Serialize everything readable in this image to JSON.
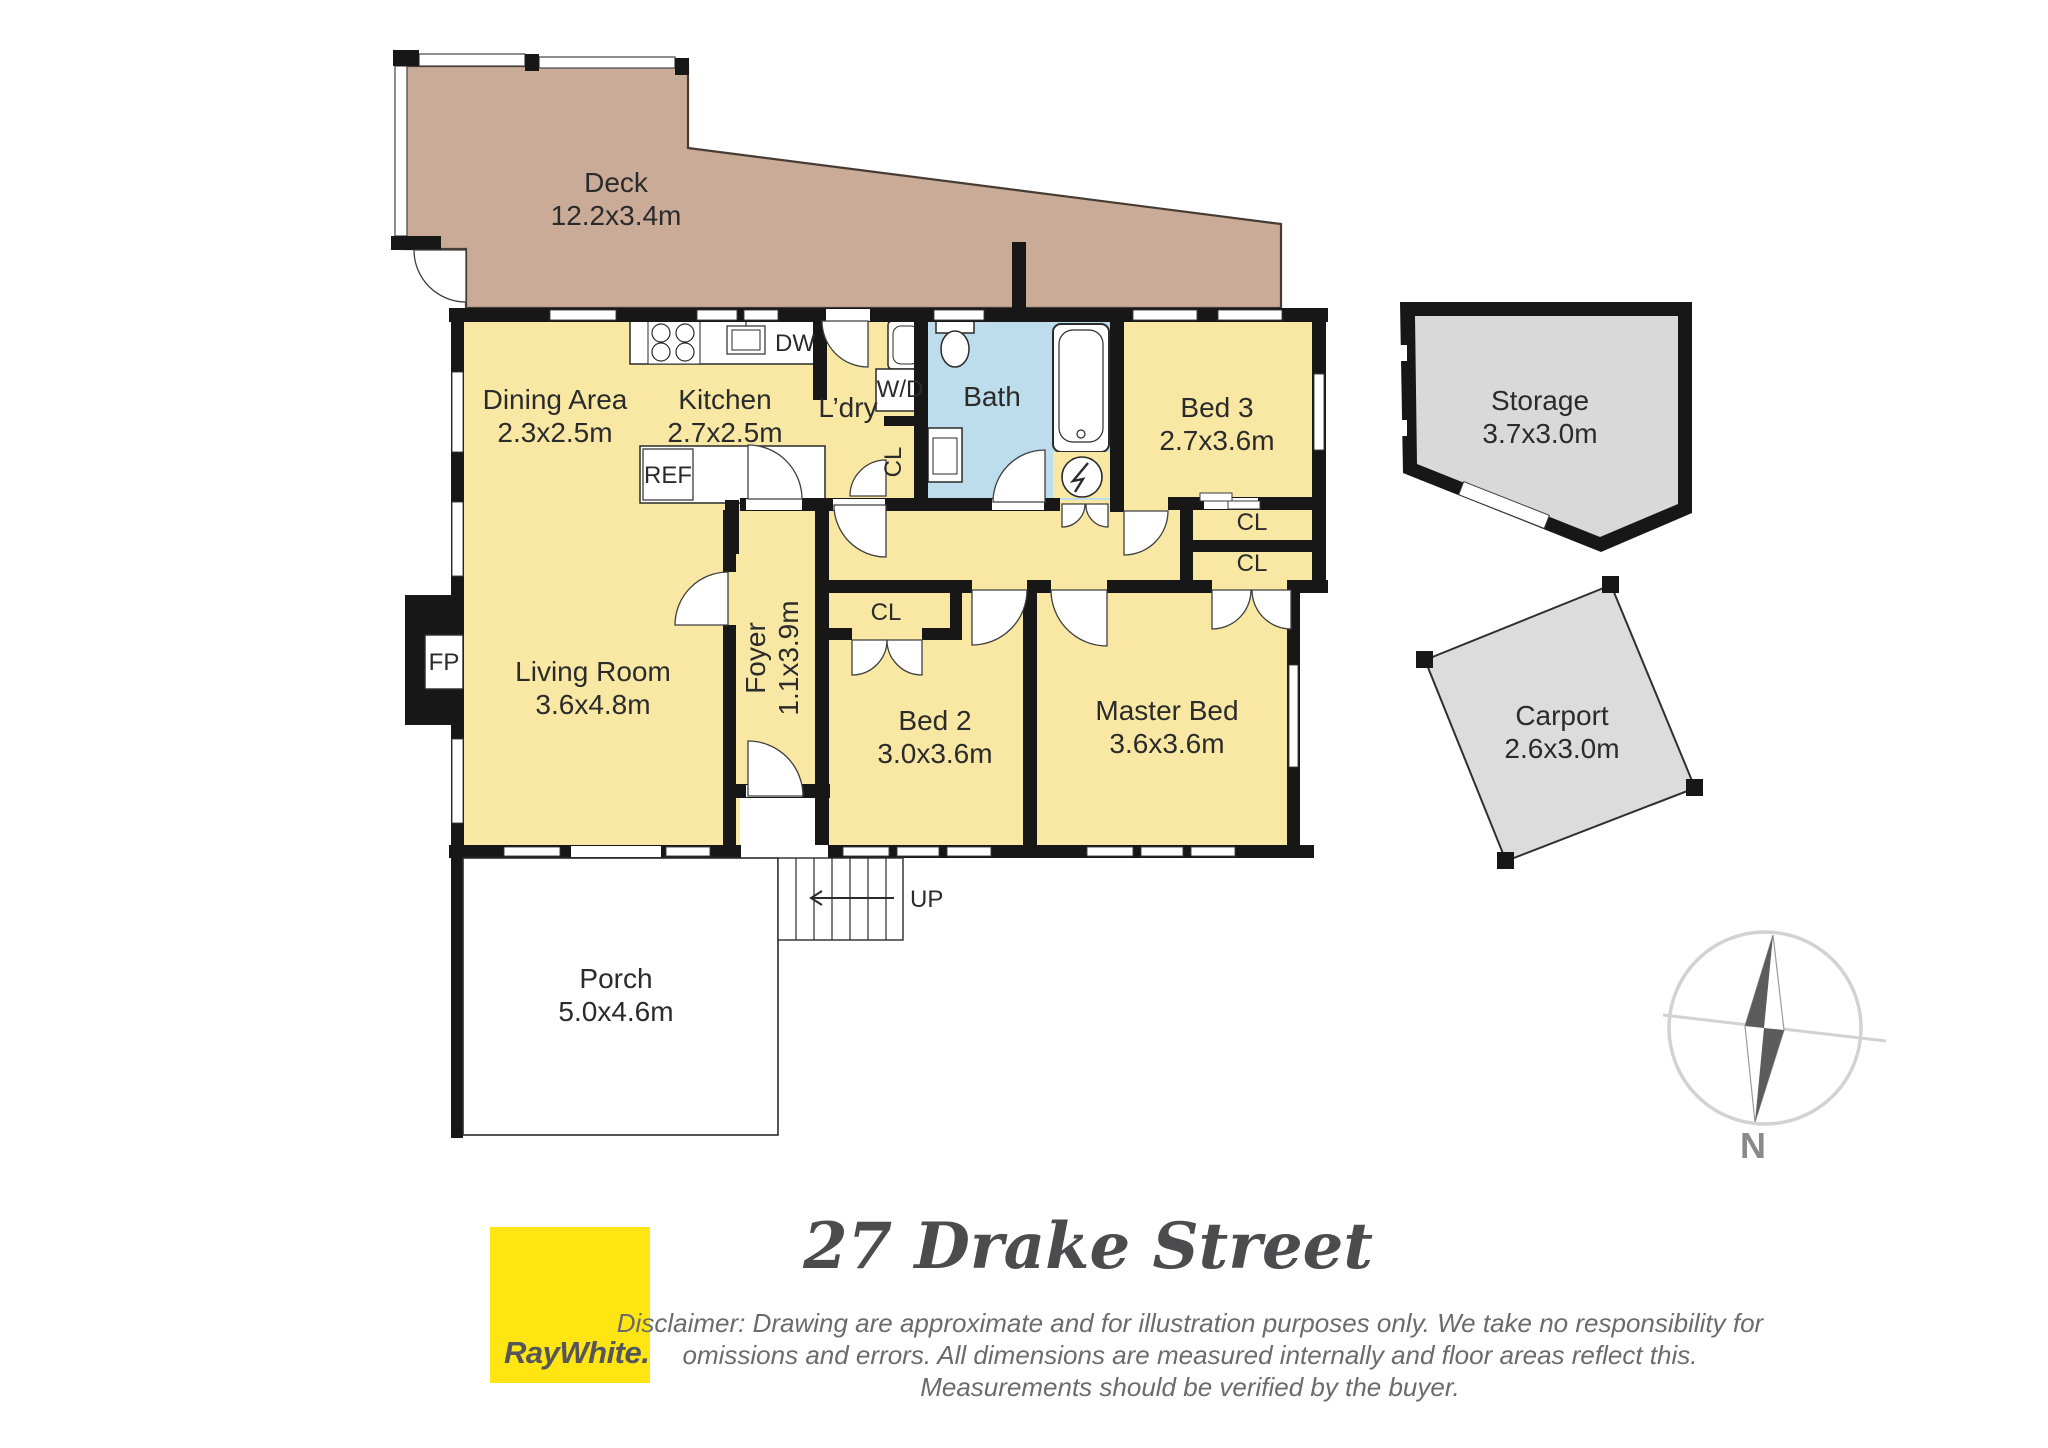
{
  "floorplan": {
    "rooms": {
      "deck": {
        "name": "Deck",
        "dims": "12.2x3.4m"
      },
      "dining": {
        "name": "Dining Area",
        "dims": "2.3x2.5m"
      },
      "kitchen": {
        "name": "Kitchen",
        "dims": "2.7x2.5m"
      },
      "laundry": {
        "name": "L’dry"
      },
      "bath": {
        "name": "Bath"
      },
      "bed3": {
        "name": "Bed 3",
        "dims": "2.7x3.6m"
      },
      "living": {
        "name": "Living Room",
        "dims": "3.6x4.8m"
      },
      "foyer": {
        "name": "Foyer",
        "dims": "1.1x3.9m"
      },
      "bed2": {
        "name": "Bed 2",
        "dims": "3.0x3.6m"
      },
      "master": {
        "name": "Master Bed",
        "dims": "3.6x3.6m"
      },
      "porch": {
        "name": "Porch",
        "dims": "5.0x4.6m"
      },
      "storage": {
        "name": "Storage",
        "dims": "3.7x3.0m"
      },
      "carport": {
        "name": "Carport",
        "dims": "2.6x3.0m"
      }
    },
    "fixtures": {
      "dishwasher": "DW",
      "washer_dryer": "W/D",
      "refrigerator": "REF",
      "fireplace": "FP",
      "closet": "CL",
      "stairs_up": "UP"
    },
    "compass": {
      "north": "N"
    }
  },
  "footer": {
    "title": "27 Drake Street",
    "brand": {
      "logo_text": "RayWhite."
    },
    "disclaimer": {
      "line1": "Disclaimer: Drawing are approximate and for illustration purposes only. We take no responsibility for",
      "line2": "omissions and errors. All dimensions are measured internally and floor areas reflect this.",
      "line3": "Measurements should be verified by the buyer."
    }
  },
  "colors": {
    "room_fill": "#f8e8a3",
    "deck_fill": "#c9ab97",
    "bath_fill": "#bddcec",
    "outdoor_fill": "#d9d9d9",
    "wall": "#171717",
    "brand_yellow": "#ffe512",
    "label_text": "#2b2b2b"
  }
}
